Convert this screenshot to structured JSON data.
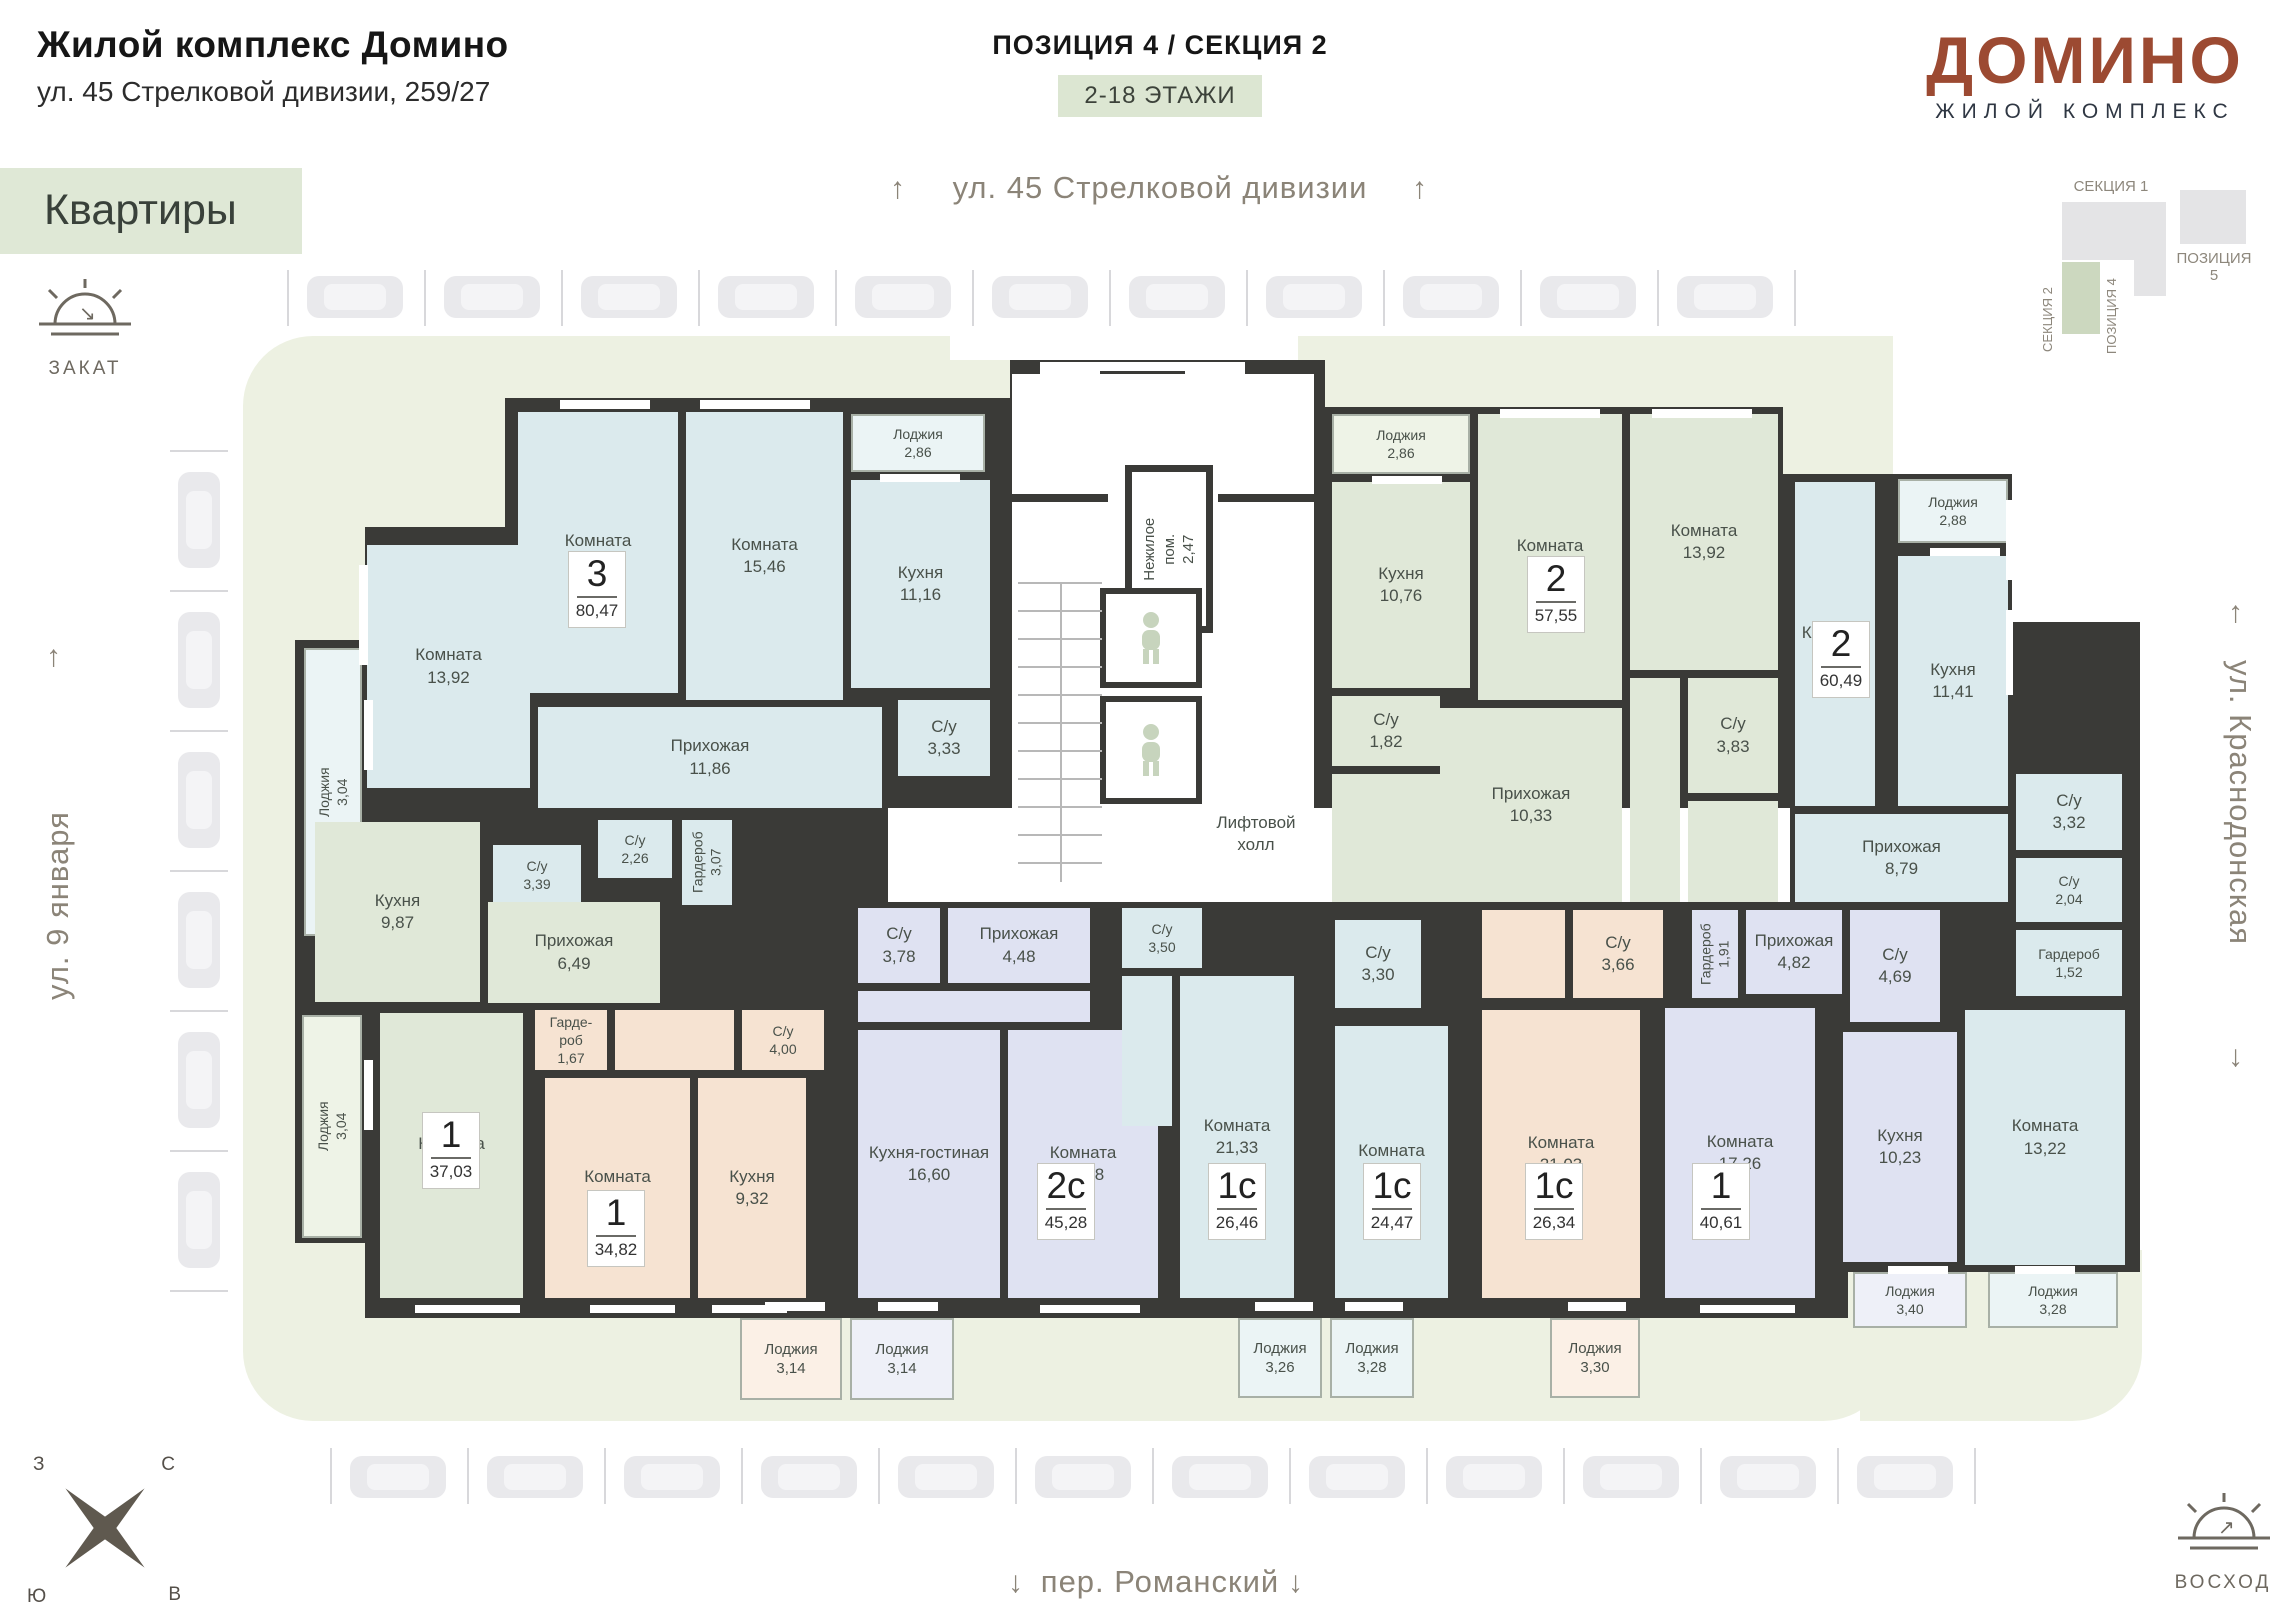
{
  "header": {
    "title": "Жилой комплекс Домино",
    "address": "ул. 45 Стрелковой дивизии, 259/27",
    "position_label": "ПОЗИЦИЯ 4 / СЕКЦИЯ 2",
    "floors_badge": "2-18 ЭТАЖИ",
    "logo": "ДОМИНО",
    "logo_subtitle": "ЖИЛОЙ КОМПЛЕКС",
    "brand_color": "#9c4a32"
  },
  "banner": {
    "label": "Квартиры"
  },
  "streets": {
    "top": "ул. 45 Стрелковой дивизии",
    "left": "ул. 9 января",
    "right": "ул. Краснодонская",
    "bottom": "пер. Романский"
  },
  "sun_icons": {
    "sunset": "ЗАКАТ",
    "sunrise": "ВОСХОД"
  },
  "compass": {
    "west": "З",
    "north": "С",
    "south": "Ю",
    "east": "В"
  },
  "site_plan": {
    "section1": "СЕКЦИЯ 1",
    "section2": "СЕКЦИЯ 2",
    "position4": "ПОЗИЦИЯ 4",
    "position5": "ПОЗИЦИЯ 5",
    "highlight_color": "#ccd8bf"
  },
  "stairwell": {
    "non_residential_name": "Нежилое пом.",
    "non_residential_area": "2,47",
    "elevator_hall": "Лифтовой холл"
  },
  "parking": {
    "top_count": 11,
    "left_count": 6,
    "bottom_count": 12
  },
  "apartments": [
    {
      "type": "3",
      "area": "80,47",
      "color": "#dbeaed",
      "badge": [
        568,
        551
      ],
      "rooms": [
        {
          "n": "Комната",
          "a": "16,46",
          "b": [
            518,
            412,
            160,
            281
          ]
        },
        {
          "n": "Комната",
          "a": "15,46",
          "b": [
            686,
            412,
            157,
            288
          ]
        },
        {
          "n": "Кухня",
          "a": "11,16",
          "b": [
            851,
            480,
            139,
            208
          ]
        },
        {
          "n": "Лоджия",
          "a": "2,86",
          "b": [
            851,
            414,
            134,
            58
          ],
          "f": "#ebf4f5"
        },
        {
          "n": "Комната",
          "a": "13,92",
          "b": [
            367,
            545,
            163,
            243
          ]
        },
        {
          "n": "Прихожая",
          "a": "11,86",
          "b": [
            538,
            707,
            344,
            101
          ]
        },
        {
          "n": "С/у",
          "a": "3,33",
          "b": [
            898,
            700,
            92,
            76
          ]
        },
        {
          "n": "С/у",
          "a": "2,26",
          "b": [
            598,
            820,
            74,
            58
          ]
        },
        {
          "n": "Гардероб",
          "a": "3,07",
          "b": [
            682,
            820,
            50,
            85
          ],
          "rot": true
        },
        {
          "n": "С/у",
          "a": "3,39",
          "b": [
            493,
            845,
            88,
            60
          ]
        },
        {
          "n": "Лоджия",
          "a": "3,04",
          "b": [
            304,
            648,
            58,
            288
          ],
          "rot": true,
          "f": "#ebf4f5"
        }
      ]
    },
    {
      "type": "1",
      "area": "37,03",
      "color": "#e0e8d8",
      "badge": [
        422,
        1112
      ],
      "rooms": [
        {
          "n": "Кухня",
          "a": "9,87",
          "b": [
            315,
            822,
            165,
            180
          ]
        },
        {
          "n": "Прихожая",
          "a": "6,49",
          "b": [
            488,
            902,
            172,
            101
          ]
        },
        {
          "n": "Комната",
          "a": "15,38",
          "b": [
            380,
            1013,
            143,
            285
          ]
        },
        {
          "n": "Лоджия",
          "a": "3,04",
          "b": [
            302,
            1015,
            60,
            223
          ],
          "rot": true,
          "f": "#eef3e7"
        }
      ]
    },
    {
      "type": "1",
      "area": "34,82",
      "color": "#f6e3d2",
      "badge": [
        587,
        1190
      ],
      "rooms": [
        {
          "n": "Гарде-\nроб",
          "a": "1,67",
          "b": [
            535,
            1010,
            72,
            60
          ]
        },
        {
          "n": "",
          "a": "",
          "b": [
            615,
            1010,
            119,
            60
          ]
        },
        {
          "n": "С/у",
          "a": "4,00",
          "b": [
            742,
            1010,
            82,
            60
          ]
        },
        {
          "n": "Комната",
          "a": "13,69",
          "b": [
            545,
            1078,
            145,
            220
          ]
        },
        {
          "n": "Кухня",
          "a": "9,32",
          "b": [
            698,
            1078,
            108,
            220
          ]
        },
        {
          "n": "Лоджия",
          "a": "3,14",
          "b": [
            740,
            1318,
            102,
            82
          ],
          "f": "#fbf0e6"
        }
      ]
    },
    {
      "type": "2с",
      "area": "45,28",
      "color": "#dfe2f2",
      "badge": [
        1037,
        1163
      ],
      "rooms": [
        {
          "n": "С/у",
          "a": "3,78",
          "b": [
            858,
            908,
            82,
            75
          ]
        },
        {
          "n": "Прихожая",
          "a": "4,48",
          "b": [
            948,
            908,
            142,
            75
          ]
        },
        {
          "n": "",
          "a": "",
          "b": [
            858,
            991,
            232,
            31
          ]
        },
        {
          "n": "Кухня-гостиная",
          "a": "16,60",
          "b": [
            858,
            1030,
            142,
            268
          ]
        },
        {
          "n": "Комната",
          "a": "17,28",
          "b": [
            1008,
            1030,
            150,
            268
          ]
        },
        {
          "n": "Лоджия",
          "a": "3,14",
          "b": [
            850,
            1318,
            104,
            82
          ],
          "f": "#eef0f8"
        }
      ]
    },
    {
      "type": "1с",
      "area": "26,46",
      "color": "#dbeaed",
      "badge": [
        1208,
        1163
      ],
      "rooms": [
        {
          "n": "С/у",
          "a": "3,50",
          "b": [
            1122,
            908,
            80,
            60
          ]
        },
        {
          "n": "",
          "a": "",
          "b": [
            1122,
            976,
            50,
            150
          ]
        },
        {
          "n": "Комната",
          "a": "21,33",
          "b": [
            1180,
            976,
            114,
            322
          ]
        },
        {
          "n": "Лоджия",
          "a": "3,26",
          "b": [
            1238,
            1318,
            84,
            80
          ],
          "f": "#ebf4f5"
        }
      ]
    },
    {
      "type": "1с",
      "area": "24,47",
      "color": "#dbeaed",
      "badge": [
        1363,
        1163
      ],
      "rooms": [
        {
          "n": "С/у",
          "a": "3,30",
          "b": [
            1335,
            920,
            86,
            88
          ]
        },
        {
          "n": "Комната",
          "a": "19,53",
          "b": [
            1335,
            1026,
            113,
            272
          ]
        },
        {
          "n": "Лоджия",
          "a": "3,28",
          "b": [
            1330,
            1318,
            84,
            80
          ],
          "f": "#ebf4f5"
        }
      ]
    },
    {
      "type": "1с",
      "area": "26,34",
      "color": "#f6e3d2",
      "badge": [
        1525,
        1163
      ],
      "rooms": [
        {
          "n": "С/у",
          "a": "3,66",
          "b": [
            1573,
            910,
            90,
            88
          ]
        },
        {
          "n": "",
          "a": "",
          "b": [
            1482,
            910,
            83,
            88
          ]
        },
        {
          "n": "Комната",
          "a": "21,03",
          "b": [
            1482,
            1010,
            158,
            288
          ]
        },
        {
          "n": "Лоджия",
          "a": "3,30",
          "b": [
            1550,
            1318,
            90,
            80
          ],
          "f": "#fbf0e6"
        }
      ]
    },
    {
      "type": "1",
      "area": "40,61",
      "color": "#dfe2f2",
      "badge": [
        1692,
        1163
      ],
      "rooms": [
        {
          "n": "Гардероб",
          "a": "1,91",
          "b": [
            1692,
            910,
            46,
            88
          ],
          "rot": true
        },
        {
          "n": "Прихожая",
          "a": "4,82",
          "b": [
            1746,
            910,
            96,
            84
          ]
        },
        {
          "n": "С/у",
          "a": "4,69",
          "b": [
            1850,
            910,
            90,
            112
          ]
        },
        {
          "n": "Комната",
          "a": "17,26",
          "b": [
            1665,
            1008,
            150,
            290
          ]
        },
        {
          "n": "Кухня",
          "a": "10,23",
          "b": [
            1843,
            1032,
            114,
            230
          ]
        },
        {
          "n": "Лоджия",
          "a": "3,40",
          "b": [
            1853,
            1272,
            114,
            56
          ],
          "f": "#eef0f8"
        }
      ]
    },
    {
      "type": "2",
      "area": "57,55",
      "color": "#e0e8d8",
      "badge": [
        1527,
        556
      ],
      "rooms": [
        {
          "n": "Лоджия",
          "a": "2,86",
          "b": [
            1332,
            414,
            138,
            60
          ],
          "f": "#eef3e7"
        },
        {
          "n": "Кухня",
          "a": "10,76",
          "b": [
            1332,
            482,
            138,
            206
          ]
        },
        {
          "n": "Комната",
          "a": "15,46",
          "b": [
            1478,
            414,
            144,
            286
          ]
        },
        {
          "n": "Комната",
          "a": "13,92",
          "b": [
            1630,
            414,
            148,
            256
          ]
        },
        {
          "n": "С/у",
          "a": "1,82",
          "b": [
            1332,
            696,
            108,
            70
          ]
        },
        {
          "n": "",
          "a": "",
          "b": [
            1332,
            774,
            108,
            128
          ]
        },
        {
          "n": "Прихожая",
          "a": "10,33",
          "b": [
            1440,
            708,
            182,
            194
          ]
        },
        {
          "n": "С/у",
          "a": "3,83",
          "b": [
            1688,
            678,
            90,
            115
          ]
        },
        {
          "n": "",
          "a": "",
          "b": [
            1630,
            678,
            50,
            224
          ]
        },
        {
          "n": "",
          "a": "",
          "b": [
            1688,
            801,
            90,
            101
          ]
        }
      ]
    },
    {
      "type": "2",
      "area": "60,49",
      "color": "#dbeaed",
      "badge": [
        1812,
        621
      ],
      "rooms": [
        {
          "n": "Комната",
          "a": "17,11",
          "b": [
            1795,
            482,
            80,
            324
          ]
        },
        {
          "n": "Кухня",
          "a": "11,41",
          "b": [
            1898,
            556,
            110,
            250
          ]
        },
        {
          "n": "Лоджия",
          "a": "2,88",
          "b": [
            1898,
            479,
            110,
            64
          ],
          "f": "#ebf4f5"
        },
        {
          "n": "Прихожая",
          "a": "8,79",
          "b": [
            1795,
            814,
            213,
            88
          ]
        },
        {
          "n": "С/у",
          "a": "3,32",
          "b": [
            2016,
            774,
            106,
            76
          ]
        },
        {
          "n": "С/у",
          "a": "2,04",
          "b": [
            2016,
            858,
            106,
            64
          ]
        },
        {
          "n": "Гардероб",
          "a": "1,52",
          "b": [
            2016,
            930,
            106,
            66
          ]
        },
        {
          "n": "Комната",
          "a": "13,22",
          "b": [
            1965,
            1010,
            160,
            255
          ]
        },
        {
          "n": "Лоджия",
          "a": "3,28",
          "b": [
            1988,
            1272,
            130,
            56
          ],
          "f": "#ebf4f5"
        }
      ]
    }
  ],
  "windows": [
    [
      560,
      400,
      90,
      9
    ],
    [
      700,
      400,
      110,
      9
    ],
    [
      1100,
      362,
      140,
      9
    ],
    [
      1040,
      362,
      60,
      12
    ],
    [
      1185,
      362,
      60,
      12
    ],
    [
      1500,
      409,
      100,
      9
    ],
    [
      1652,
      409,
      100,
      9
    ],
    [
      359,
      565,
      9,
      100
    ],
    [
      2006,
      500,
      7,
      80
    ],
    [
      2006,
      610,
      7,
      85
    ],
    [
      415,
      1305,
      105,
      8
    ],
    [
      590,
      1305,
      85,
      8
    ],
    [
      712,
      1305,
      75,
      8
    ],
    [
      1040,
      1305,
      100,
      8
    ],
    [
      1700,
      1305,
      95,
      8
    ],
    [
      880,
      474,
      80,
      8
    ],
    [
      1372,
      476,
      70,
      8
    ],
    [
      1930,
      548,
      70,
      8
    ],
    [
      765,
      1302,
      60,
      9
    ],
    [
      878,
      1302,
      60,
      9
    ],
    [
      1255,
      1302,
      58,
      9
    ],
    [
      1345,
      1302,
      58,
      9
    ],
    [
      1568,
      1302,
      58,
      9
    ],
    [
      1888,
      1266,
      60,
      8
    ],
    [
      2015,
      1266,
      60,
      8
    ],
    [
      364,
      700,
      9,
      70
    ],
    [
      364,
      1060,
      9,
      70
    ]
  ]
}
